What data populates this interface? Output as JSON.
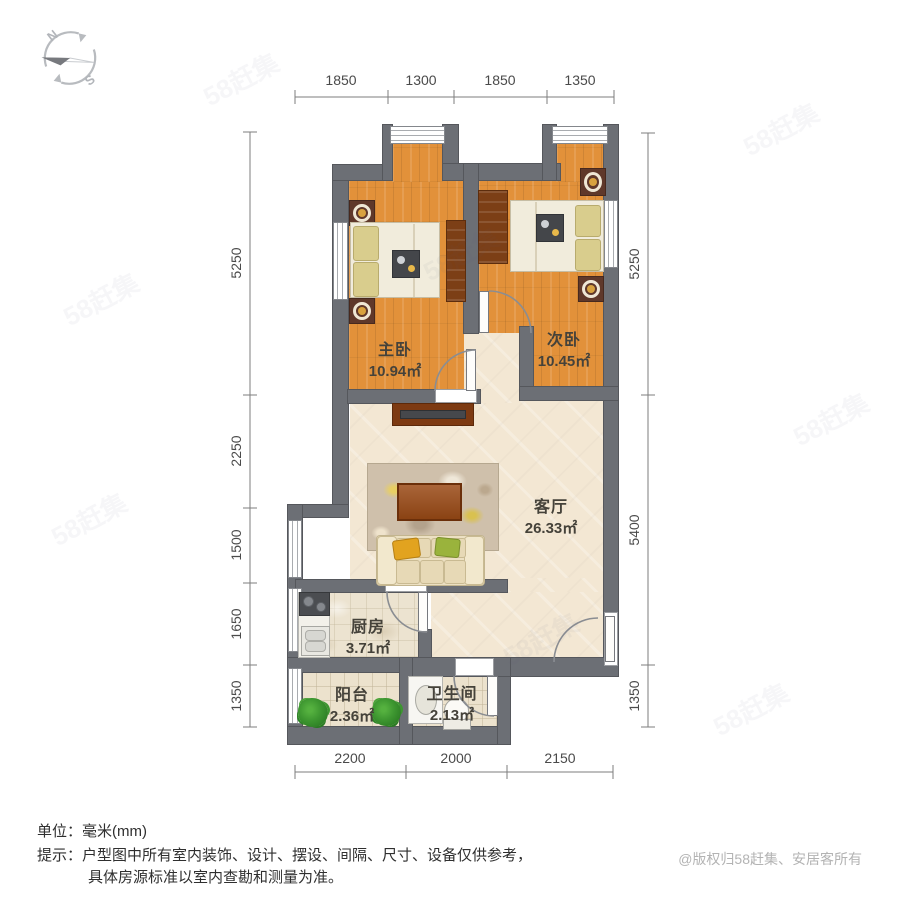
{
  "compass": {
    "north": "N",
    "south": "S"
  },
  "rooms": [
    {
      "name": "主卧",
      "area": "10.94㎡"
    },
    {
      "name": "次卧",
      "area": "10.45㎡"
    },
    {
      "name": "客厅",
      "area": "26.33㎡"
    },
    {
      "name": "厨房",
      "area": "3.71㎡"
    },
    {
      "name": "阳台",
      "area": "2.36㎡"
    },
    {
      "name": "卫生间",
      "area": "2.13㎡"
    }
  ],
  "dimensions": {
    "top": [
      "1850",
      "1300",
      "1850",
      "1350"
    ],
    "left": [
      "5250",
      "2250",
      "1500",
      "1650",
      "1350"
    ],
    "right": [
      "5250",
      "5400",
      "1350"
    ],
    "bottom": [
      "2200",
      "2000",
      "2150"
    ]
  },
  "footer": {
    "unit_label": "单位：毫米(mm)",
    "tip_line1": "提示：户型图中所有室内装饰、设计、摆设、间隔、尺寸、设备仅供参考，",
    "tip_line2": "具体房源标准以室内查勘和测量为准。",
    "copyright": "@版权归58赶集、安居客所有"
  },
  "watermark": {
    "text": "58赶集"
  },
  "colors": {
    "wall": "#6c6f75",
    "wood_floor": "#e2913a",
    "living_floor": "#f3e7d3",
    "mat_red": "#5f382a",
    "copyright_gray": "#b3b3b3"
  }
}
